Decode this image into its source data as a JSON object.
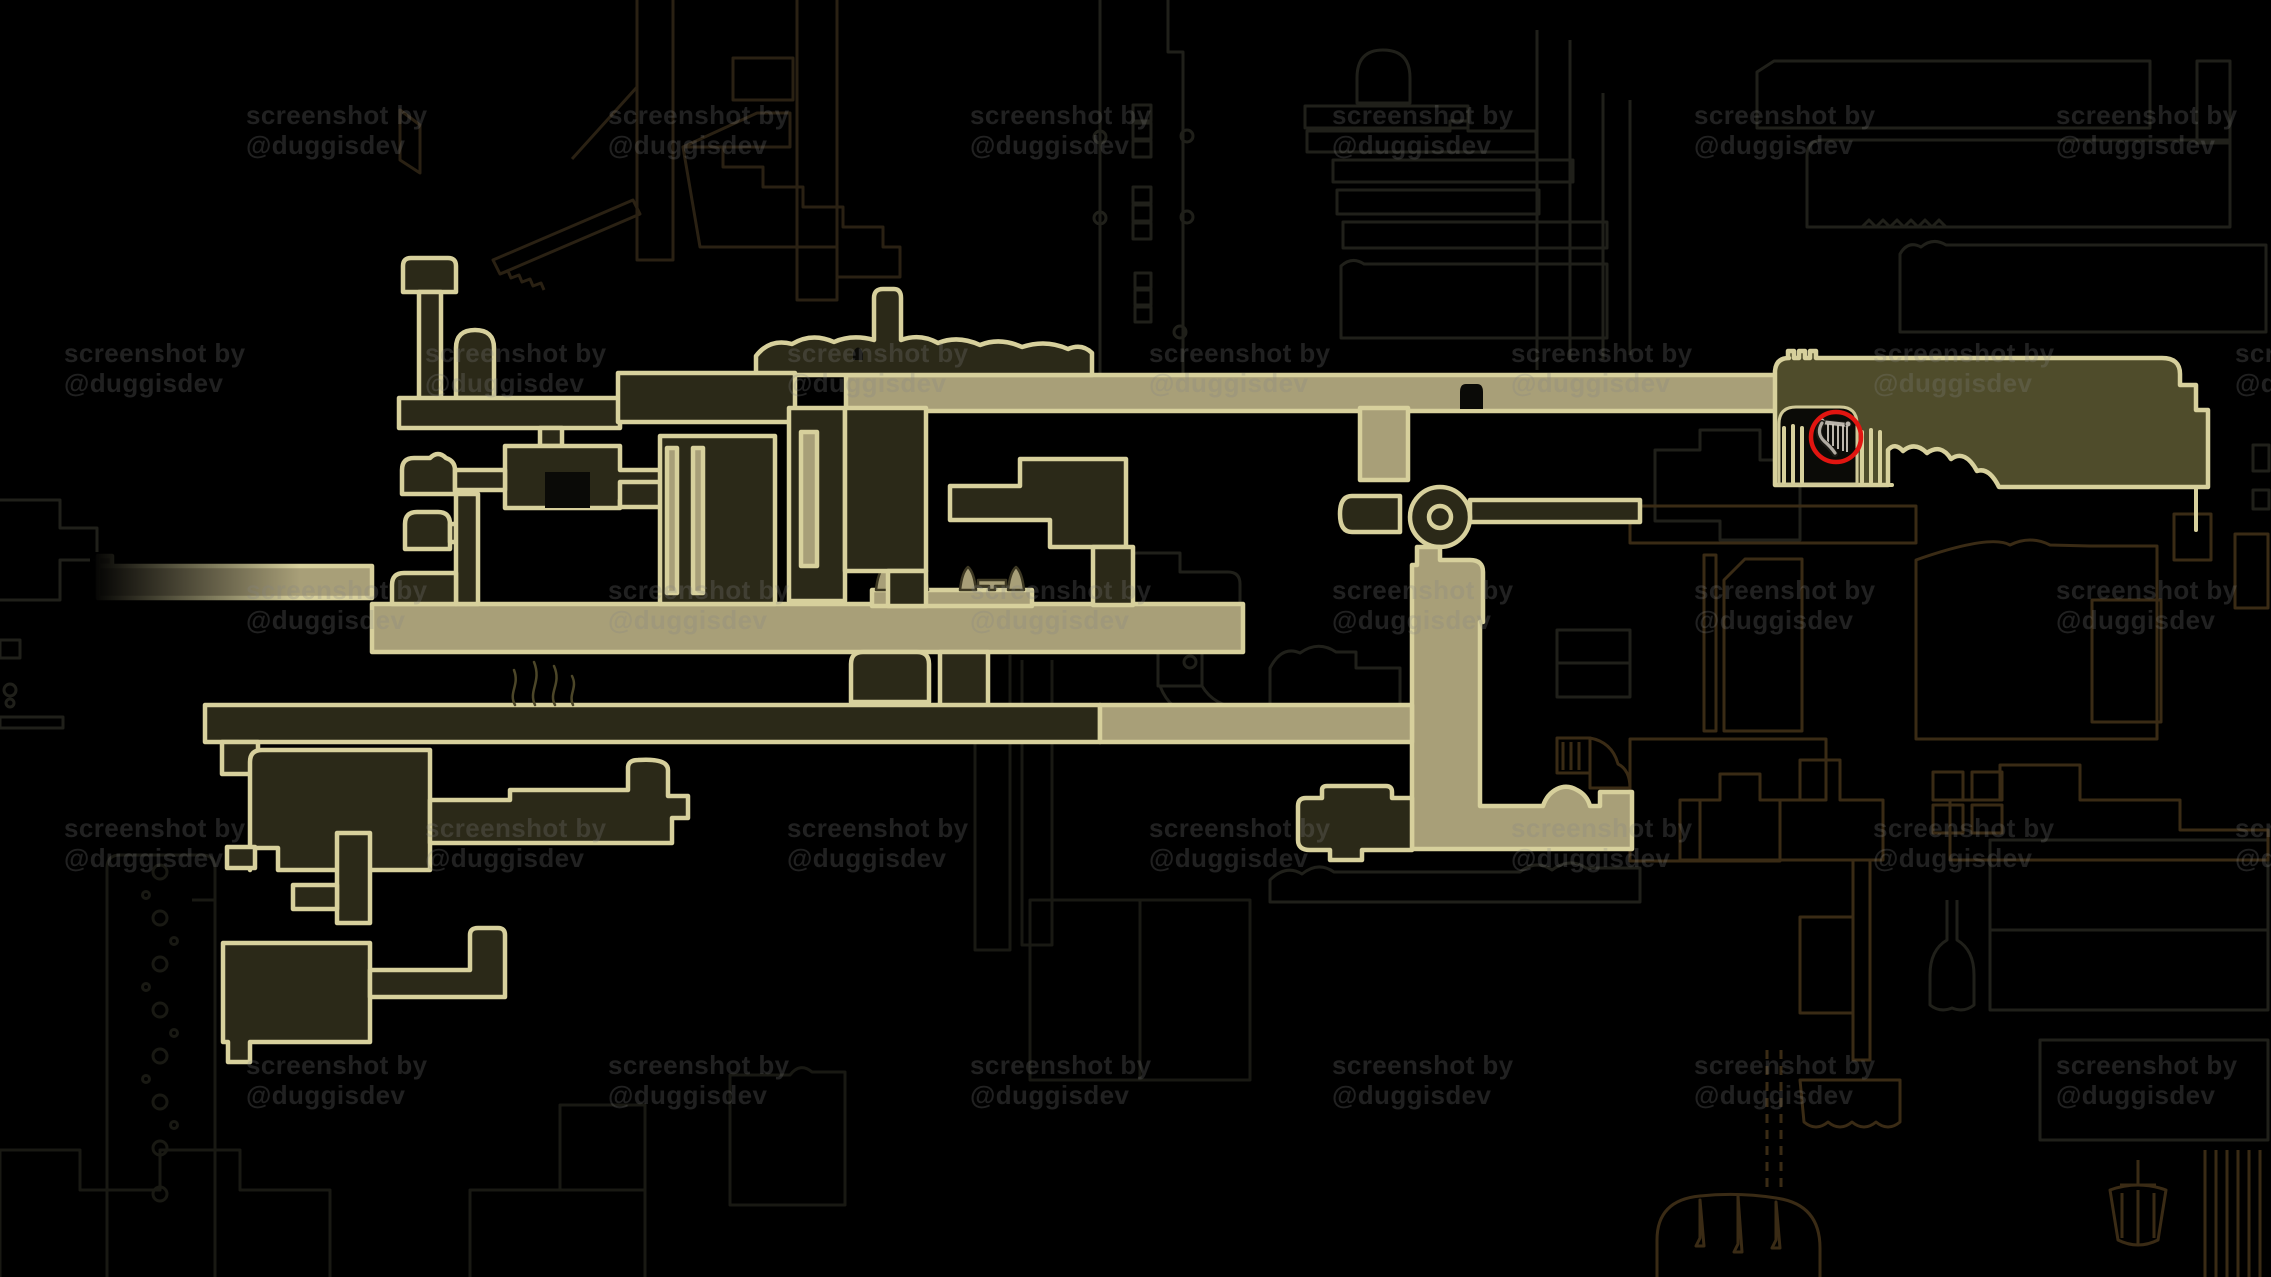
{
  "scene": {
    "kind": "game-world-map-screenshot",
    "width": 2271,
    "height": 1277,
    "description": "dark metroidvania map with explored pale-gold rooms, faint unexplored outlines, tiled watermark and a red circle marking a harp icon"
  },
  "watermark": {
    "line1": "screenshot by",
    "line2": "@duggisdev",
    "rows": [
      {
        "y": 100,
        "xs": [
          246,
          608,
          970,
          1332,
          1694,
          2056
        ]
      },
      {
        "y": 338,
        "xs": [
          64,
          425,
          787,
          1149,
          1511,
          1873,
          2235
        ]
      },
      {
        "y": 575,
        "xs": [
          246,
          608,
          970,
          1332,
          1694,
          2056
        ]
      },
      {
        "y": 813,
        "xs": [
          64,
          425,
          787,
          1149,
          1511,
          1873,
          2235
        ]
      },
      {
        "y": 1050,
        "xs": [
          246,
          608,
          970,
          1332,
          1694,
          2056
        ]
      }
    ]
  },
  "marker": {
    "icon": "harp-icon",
    "shape": "red-circle",
    "x": 1836,
    "y": 437,
    "radius": 25
  },
  "colors": {
    "bg": "#000000",
    "bright": "#d7d09c",
    "tan": "#a89f78",
    "roomfill": "#2b2918",
    "bigfill": "#4f4c2b",
    "gray": "#20201a",
    "gray2": "#191913",
    "brown": "#3a2b15",
    "brown2": "#2a2113",
    "glyph": "#3d3823",
    "flame": "#4c4628",
    "red": "#e11510",
    "harp_silver": "#b9b4aa",
    "harp_shadow": "#55524b",
    "wmcolor": "rgba(130,130,130,0.25)"
  },
  "icons": [
    {
      "name": "harp-icon",
      "meaning": "circled quest location"
    },
    {
      "name": "wheel-icon",
      "meaning": "round hub room"
    },
    {
      "name": "bench-icon",
      "meaning": "rest point glyphs on corridor"
    },
    {
      "name": "spike-icon",
      "meaning": "cone spikes beside benches"
    },
    {
      "name": "flame-icon",
      "meaning": "small flames on corridor top"
    },
    {
      "name": "bell-lamp-icon",
      "meaning": "tiny lamp on surface mound"
    },
    {
      "name": "chain-icon",
      "meaning": "hanging chain in left tower"
    },
    {
      "name": "tassel-dome-icon",
      "meaning": "mound with hanging tassels bottom right"
    },
    {
      "name": "chandelier-icon",
      "meaning": "brown chandelier bottom right"
    }
  ]
}
